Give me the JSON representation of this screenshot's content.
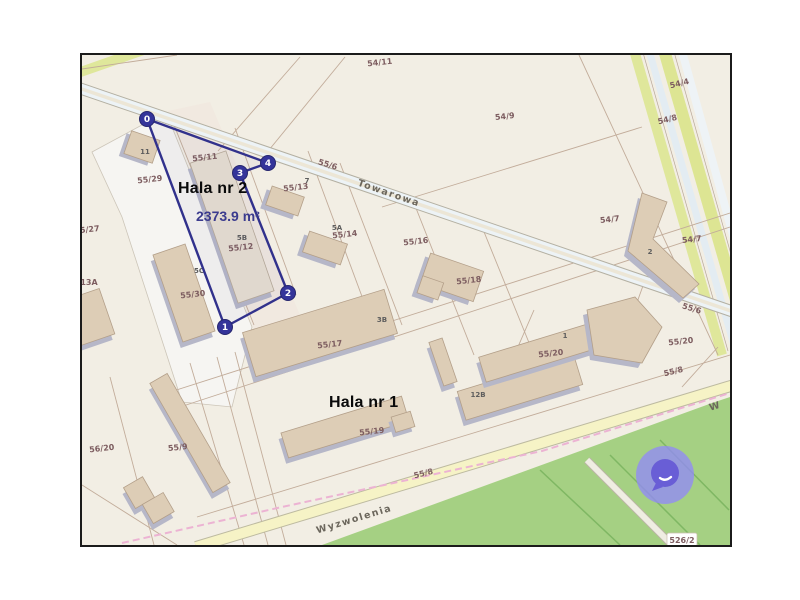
{
  "window": {
    "background": "#ffffff"
  },
  "map": {
    "type": "cadastral-map",
    "border_color": "#1b1b1b",
    "background_color": "#f2eee4",
    "streets": [
      {
        "name": "Towarowa",
        "x": 306,
        "y": 141,
        "rot": 19
      },
      {
        "name": "Wyzwolenia",
        "x": 273,
        "y": 467,
        "rot": -17
      },
      {
        "name": "W",
        "x": 634,
        "y": 354,
        "rot": -17
      }
    ],
    "parcel_labels": [
      {
        "text": "54/11",
        "x": 298,
        "y": 10,
        "rot": -6
      },
      {
        "text": "54/9",
        "x": 423,
        "y": 64,
        "rot": -6
      },
      {
        "text": "54/4",
        "x": 598,
        "y": 31,
        "rot": -14
      },
      {
        "text": "54/8",
        "x": 586,
        "y": 67,
        "rot": -14
      },
      {
        "text": "55/6",
        "x": 245,
        "y": 112,
        "rot": 17
      },
      {
        "text": "54/7",
        "x": 528,
        "y": 167,
        "rot": -6
      },
      {
        "text": "54/7",
        "x": 610,
        "y": 187,
        "rot": -6
      },
      {
        "text": "55/6",
        "x": 609,
        "y": 256,
        "rot": 17
      },
      {
        "text": "55/20",
        "x": 599,
        "y": 289,
        "rot": -6
      },
      {
        "text": "55/8",
        "x": 592,
        "y": 319,
        "rot": -14
      },
      {
        "text": "55/16",
        "x": 334,
        "y": 189,
        "rot": -6
      },
      {
        "text": "55/18",
        "x": 387,
        "y": 228,
        "rot": -6
      },
      {
        "text": "5/27",
        "x": 8,
        "y": 177,
        "rot": -6
      },
      {
        "text": "13A",
        "x": 7,
        "y": 230,
        "rot": 0
      },
      {
        "text": "55/29",
        "x": 68,
        "y": 127,
        "rot": -6
      },
      {
        "text": "55/11",
        "x": 123,
        "y": 105,
        "rot": -6
      },
      {
        "text": "55/13",
        "x": 214,
        "y": 135,
        "rot": -6
      },
      {
        "text": "55/14",
        "x": 263,
        "y": 182,
        "rot": -6
      },
      {
        "text": "55/12",
        "x": 159,
        "y": 195,
        "rot": -6
      },
      {
        "text": "55/30",
        "x": 111,
        "y": 242,
        "rot": -6
      },
      {
        "text": "55/17",
        "x": 248,
        "y": 292,
        "rot": -6
      },
      {
        "text": "55/19",
        "x": 290,
        "y": 379,
        "rot": -6
      },
      {
        "text": "55/20",
        "x": 469,
        "y": 301,
        "rot": -6
      },
      {
        "text": "56/20",
        "x": 20,
        "y": 396,
        "rot": -6
      },
      {
        "text": "55/9",
        "x": 96,
        "y": 395,
        "rot": -6
      },
      {
        "text": "55/8",
        "x": 342,
        "y": 421,
        "rot": -14
      }
    ],
    "building_labels": [
      {
        "text": "11",
        "x": 63,
        "y": 99
      },
      {
        "text": "7",
        "x": 225,
        "y": 128
      },
      {
        "text": "5A",
        "x": 255,
        "y": 175
      },
      {
        "text": "5B",
        "x": 160,
        "y": 185
      },
      {
        "text": "5C",
        "x": 117,
        "y": 218
      },
      {
        "text": "3B",
        "x": 300,
        "y": 267
      },
      {
        "text": "12B",
        "x": 396,
        "y": 342
      },
      {
        "text": "1",
        "x": 483,
        "y": 283
      },
      {
        "text": "2",
        "x": 568,
        "y": 199
      }
    ],
    "boxed_label": {
      "text": "526/2",
      "x": 600,
      "y": 487
    }
  },
  "measurement": {
    "tool": "area-measure",
    "area_label": "2373.9 m²",
    "line_color": "#31318c",
    "vertex_color": "#34349a",
    "vertices": [
      {
        "n": "0",
        "x": 65,
        "y": 64
      },
      {
        "n": "1",
        "x": 143,
        "y": 272
      },
      {
        "n": "2",
        "x": 206,
        "y": 238
      },
      {
        "n": "3",
        "x": 158,
        "y": 118
      },
      {
        "n": "4",
        "x": 186,
        "y": 108
      }
    ]
  },
  "annotations": {
    "hala2": "Hala nr 2",
    "hala1": "Hala nr 1",
    "area_text_color": "#3b3b8e"
  },
  "chat_widget": {
    "icon": "chat-bubble",
    "outer_color": "rgba(146,138,246,0.78)",
    "bubble_color": "#695ed6"
  }
}
